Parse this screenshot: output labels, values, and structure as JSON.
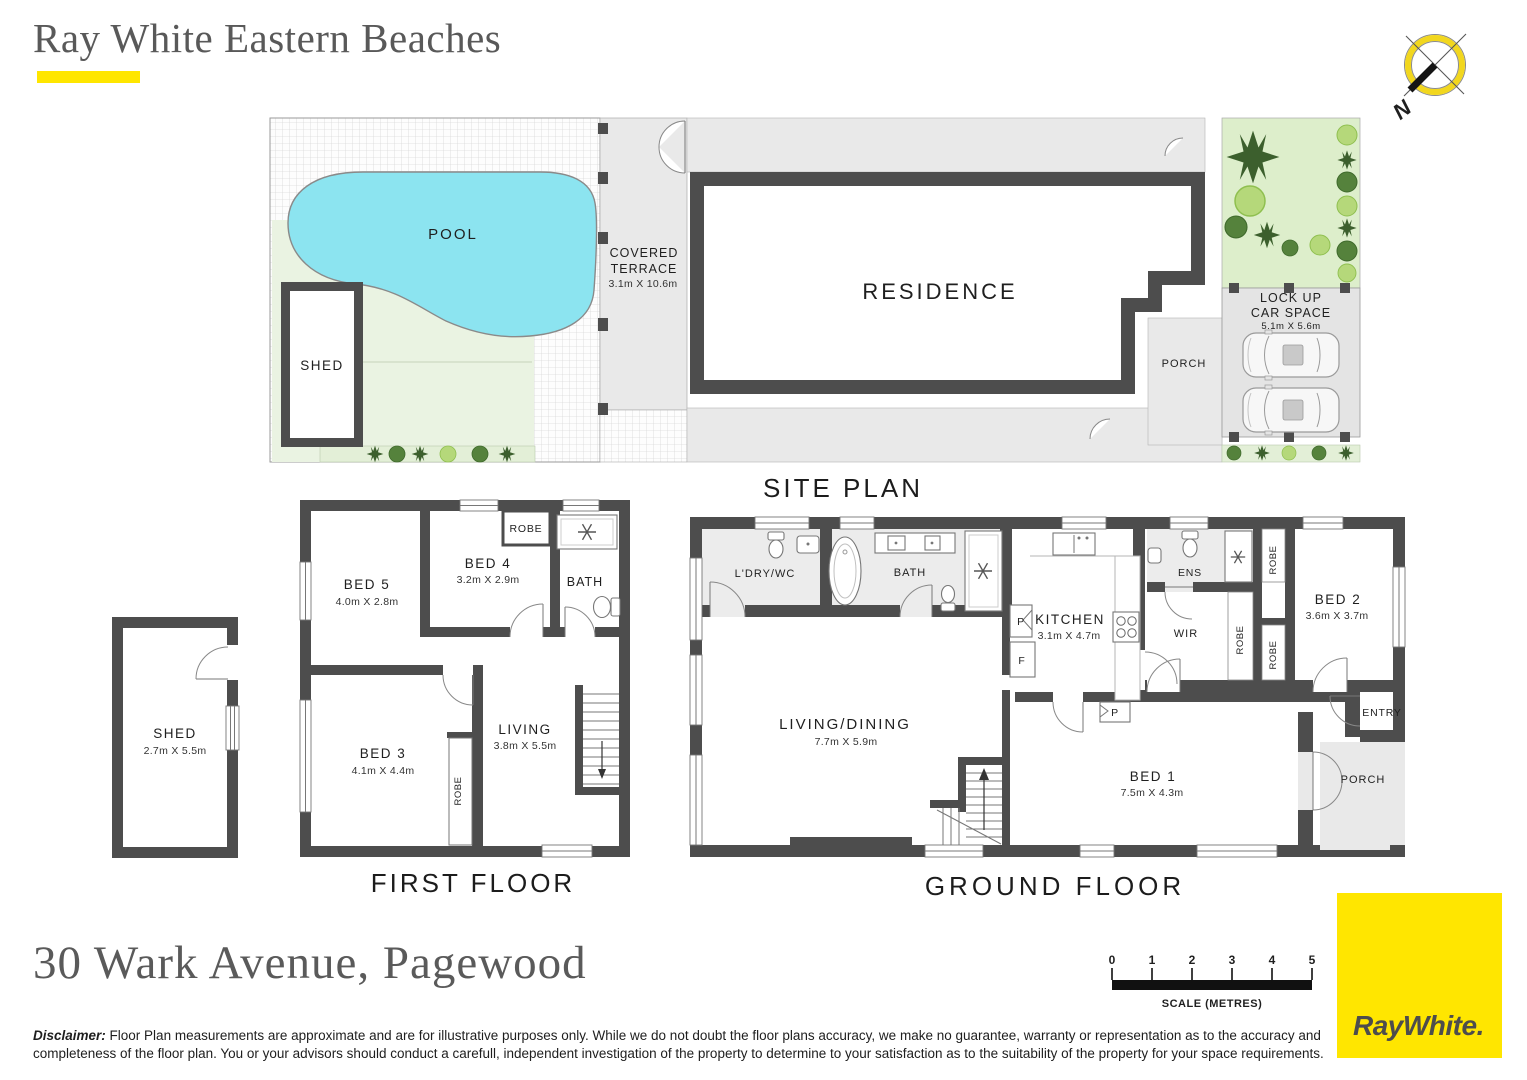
{
  "header": {
    "agency": "Ray White Eastern Beaches"
  },
  "compass": {
    "north": "N"
  },
  "site_plan": {
    "title": "SITE PLAN",
    "pool": "POOL",
    "shed": "SHED",
    "covered_terrace_line1": "COVERED",
    "covered_terrace_line2": "TERRACE",
    "covered_terrace_dims": "3.1m X 10.6m",
    "residence": "RESIDENCE",
    "porch": "PORCH",
    "car_space_line1": "LOCK UP",
    "car_space_line2": "CAR SPACE",
    "car_space_dims": "5.1m X 5.6m"
  },
  "first_floor": {
    "title": "FIRST FLOOR",
    "bed5": {
      "name": "BED 5",
      "dims": "4.0m X 2.8m"
    },
    "bed4": {
      "name": "BED 4",
      "dims": "3.2m X 2.9m"
    },
    "robe_top": "ROBE",
    "bath": "BATH",
    "bed3": {
      "name": "BED 3",
      "dims": "4.1m X 4.4m"
    },
    "robe_bed3": "ROBE",
    "living": {
      "name": "LIVING",
      "dims": "3.8m X 5.5m"
    }
  },
  "outbuilding": {
    "shed": {
      "name": "SHED",
      "dims": "2.7m X 5.5m"
    }
  },
  "ground_floor": {
    "title": "GROUND FLOOR",
    "ldry": "L'DRY/WC",
    "bath": "BATH",
    "kitchen": {
      "name": "KITCHEN",
      "dims": "3.1m X 4.7m"
    },
    "pantry": "P",
    "fridge": "F",
    "pantry2": "P",
    "ens": "ENS",
    "wir": "WIR",
    "robe1": "ROBE",
    "robe2": "ROBE",
    "robe3": "ROBE",
    "bed2": {
      "name": "BED 2",
      "dims": "3.6m X 3.7m"
    },
    "living_dining": {
      "name": "LIVING/DINING",
      "dims": "7.7m X 5.9m"
    },
    "bed1": {
      "name": "BED 1",
      "dims": "7.5m X 4.3m"
    },
    "entry": "ENTRY",
    "porch": "PORCH"
  },
  "footer": {
    "address": "30 Wark Avenue, Pagewood",
    "disclaimer_label": "Disclaimer:",
    "disclaimer_text": " Floor Plan measurements are approximate and are for illustrative purposes only. While we do not doubt the floor plans accuracy, we make no guarantee, warranty or representation as to the accuracy and completeness of the floor plan. You or your advisors should conduct a carefull, independent investigation of the property to determine to your satisfaction as to the suitability of the property for your space requirements.",
    "scale": {
      "ticks": [
        "0",
        "1",
        "2",
        "3",
        "4",
        "5"
      ],
      "label": "SCALE (METRES)"
    },
    "logo": {
      "text": "RayWhite."
    }
  },
  "colors": {
    "brand_yellow": "#FFE600",
    "wall": "#4D4D4D",
    "pool": "#8CE4F0",
    "lawn": "#EAF3E2",
    "garden": "#DDEECB",
    "paving": "#E9E9E9",
    "wet_floor": "#ECECEC"
  }
}
